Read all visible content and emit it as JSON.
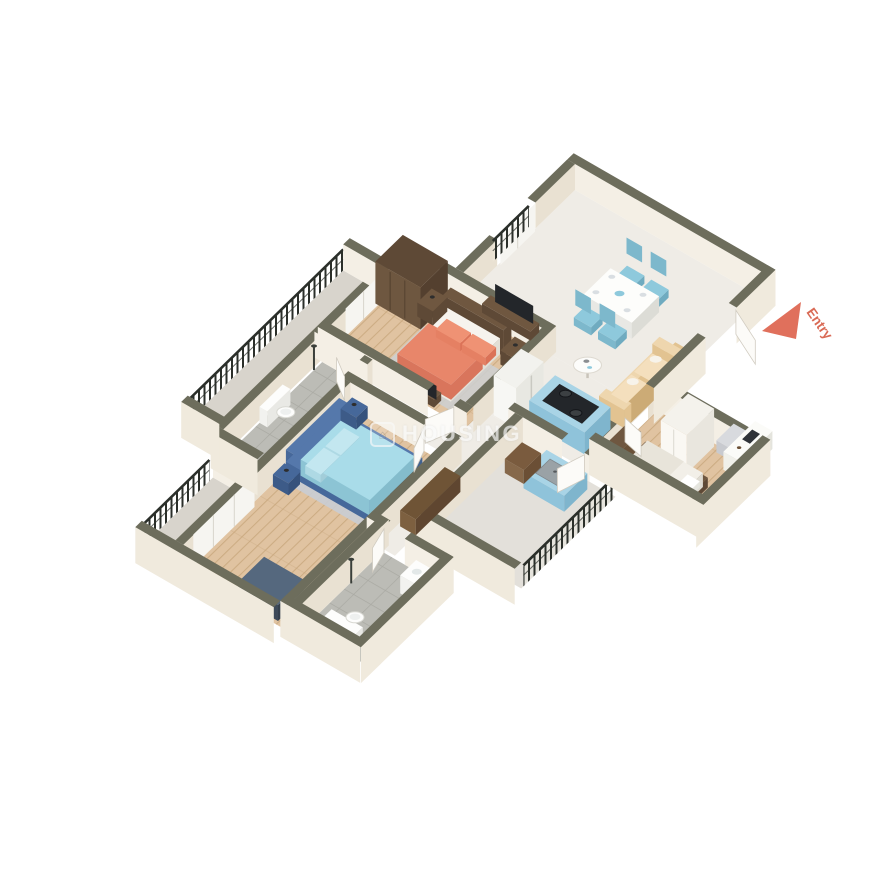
{
  "image_type": "3D isometric apartment floor plan render",
  "watermark": {
    "text": "HOUSING",
    "icon": "housing-logo-icon"
  },
  "entry_marker": {
    "label": "Entry",
    "icon": "entry-arrow-icon",
    "color": "#e0705c",
    "text_color": "#d96a55"
  },
  "colors": {
    "wall_top": "#6d6d5c",
    "wall_face": "#f4efe5",
    "wall_face_shade": "#e9e1d2",
    "wall_ext": "#f0eadd",
    "floor_wood": "#e0c3a1",
    "floor_wood_line": "#c9a87e",
    "floor_marble": "#efece6",
    "floor_tile": "#bcbcb6",
    "floor_tile_line": "#a9a9a2",
    "balcony_floor": "#d8d4cc",
    "railing": "#2b2f2a",
    "bed_master": "#e8866a",
    "bed_master_dark": "#d9755c",
    "bed2_frame": "#5578ab",
    "bed2_frame_dark": "#46689a",
    "bed2_sheet": "#a9dce9",
    "bed2_sheet_dark": "#8cc4d4",
    "kitchen_unit": "#a9d4e6",
    "kitchen_unit_face": "#8fc3da",
    "kitchen_unit_side": "#7fb5cd",
    "wood_dark": "#5e4936",
    "wood_mid": "#6f5740",
    "white_furn": "#f6f5f1",
    "rug_grey": "#cdd0d2",
    "rug_blue": "#c9cdd4",
    "sofa": "#eed6ae",
    "sofa_dark": "#e2c391",
    "chair_blue": "#8ec9dc",
    "chest_blue": "#55687e",
    "chest_blue_dark": "#3e4a59",
    "tv_dark": "#23262a",
    "steel": "#9aa2a6",
    "door_white": "#fcfbf8"
  },
  "rooms": [
    {
      "name": "Living / Dining",
      "floor": "marble",
      "furniture": [
        "dining table",
        "4 blue chairs",
        "beige sofa",
        "round coffee table",
        "wall tv unit"
      ]
    },
    {
      "name": "Open Kitchen",
      "floor": "marble",
      "furniture": [
        "blue island with hob",
        "refrigerator"
      ]
    },
    {
      "name": "Master Bedroom",
      "floor": "wood",
      "furniture": [
        "coral double bed",
        "brown wardrobe",
        "2 nightstands",
        "tv cabinet"
      ]
    },
    {
      "name": "Bedroom 2",
      "floor": "wood",
      "furniture": [
        "blue double bed",
        "2 nightstands",
        "tv",
        "white sliding wardrobe",
        "blue chest of drawers"
      ]
    },
    {
      "name": "Bedroom 3 / Study",
      "floor": "wood",
      "furniture": [
        "single bed",
        "study desk",
        "chair",
        "white wardrobe",
        "bookshelf"
      ]
    },
    {
      "name": "Bathroom 1",
      "floor": "tile",
      "furniture": [
        "toilet",
        "shower"
      ]
    },
    {
      "name": "Bathroom 2",
      "floor": "tile",
      "furniture": [
        "washbasin",
        "shower",
        "toilet"
      ]
    },
    {
      "name": "Balcony 1",
      "floor": "stone",
      "furniture": [
        "iron railing"
      ]
    },
    {
      "name": "Balcony 2",
      "floor": "stone",
      "furniture": [
        "iron railing"
      ]
    },
    {
      "name": "Utility Balcony",
      "floor": "stone",
      "furniture": [
        "wash counter with steel sink",
        "laundry hamper",
        "iron railing"
      ]
    }
  ]
}
